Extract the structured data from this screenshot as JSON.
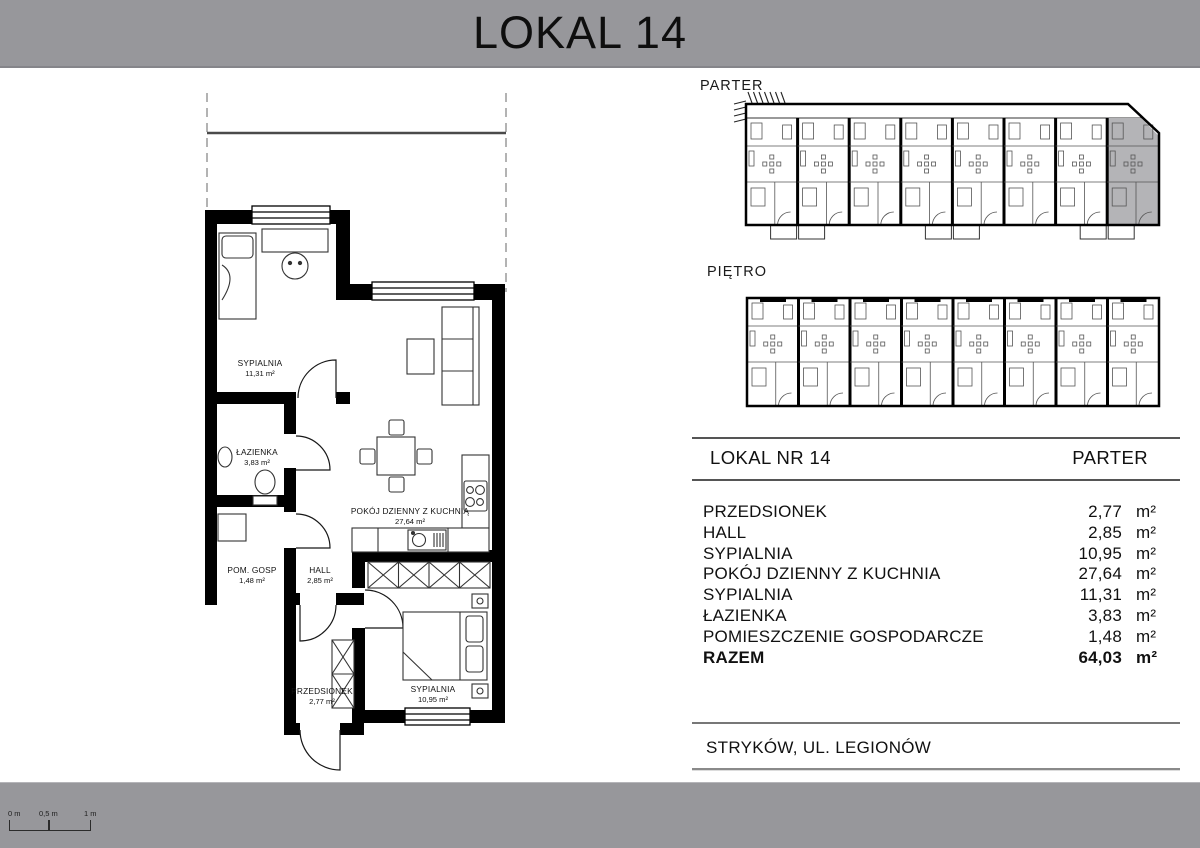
{
  "title": "LOKAL 14",
  "overview": {
    "parter_label": "PARTER",
    "pietro_label": "PIĘTRO",
    "units_per_row": 8,
    "highlighted_unit": 8
  },
  "plan": {
    "rooms": [
      {
        "name": "SYPIALNIA",
        "area": "11,31 m²"
      },
      {
        "name": "ŁAZIENKA",
        "area": "3,83 m²"
      },
      {
        "name": "POM. GOSP",
        "area": "1,48 m²"
      },
      {
        "name": "HALL",
        "area": "2,85 m²"
      },
      {
        "name": "POKÓJ DZIENNY Z KUCHNIĄ",
        "area": "27,64 m²"
      },
      {
        "name": "PRZEDSIONEK",
        "area": "2,77 m²"
      },
      {
        "name": "SYPIALNIA",
        "area": "10,95 m²"
      }
    ]
  },
  "table": {
    "header_left": "LOKAL NR 14",
    "header_right": "PARTER",
    "rows": [
      {
        "name": "PRZEDSIONEK",
        "value": "2,77",
        "unit": "m²"
      },
      {
        "name": "HALL",
        "value": "2,85",
        "unit": "m²"
      },
      {
        "name": "SYPIALNIA",
        "value": "10,95",
        "unit": "m²"
      },
      {
        "name": "POKÓJ DZIENNY Z KUCHNIA",
        "value": "27,64",
        "unit": "m²"
      },
      {
        "name": "SYPIALNIA",
        "value": "11,31",
        "unit": "m²"
      },
      {
        "name": "ŁAZIENKA",
        "value": "3,83",
        "unit": "m²"
      },
      {
        "name": "POMIESZCZENIE GOSPODARCZE",
        "value": "1,48",
        "unit": "m²"
      },
      {
        "name": "RAZEM",
        "value": "64,03",
        "unit": "m²",
        "emphasis": "bold"
      }
    ]
  },
  "address": "STRYKÓW, UL. LEGIONÓW",
  "scale_bar": {
    "labels": [
      "0 m",
      "0,5 m",
      "1 m"
    ]
  },
  "colors": {
    "bar_gray": "#97979b",
    "highlight_gray": "#b4b4b7",
    "wall_black": "#000000"
  }
}
